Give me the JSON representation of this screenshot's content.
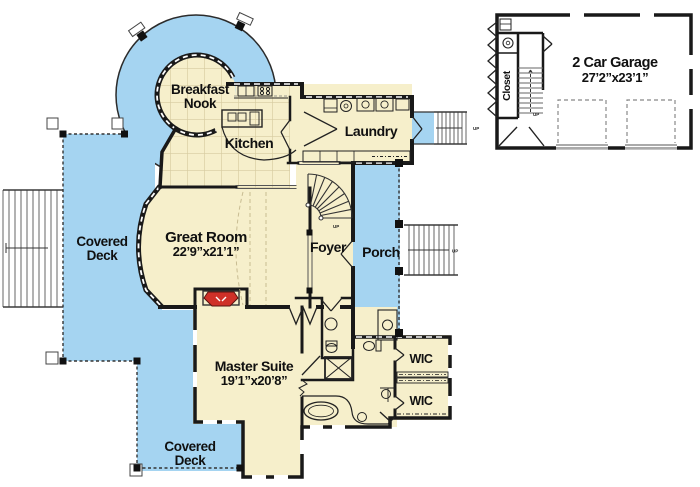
{
  "plan": {
    "labels": {
      "breakfast_nook_1": "Breakfast",
      "breakfast_nook_2": "Nook",
      "kitchen": "Kitchen",
      "laundry": "Laundry",
      "great_room": "Great Room",
      "great_room_dims": "22’9”x21’1”",
      "foyer": "Foyer",
      "porch": "Porch",
      "master_suite": "Master Suite",
      "master_suite_dims": "19’1”x20’8”",
      "wic_upper": "WIC",
      "wic_lower": "WIC",
      "deck_left_1": "Covered",
      "deck_left_2": "Deck",
      "deck_bottom_1": "Covered",
      "deck_bottom_2": "Deck",
      "garage": "2 Car Garage",
      "garage_dims": "27’2”x23’1”",
      "closet": "Closet",
      "up_landing": "UP",
      "up_porch": "UP",
      "up_foyer": "UP",
      "up_garage": "UP"
    },
    "colors": {
      "deck_blue": "#a5d4f1",
      "floor_cream": "#f6efcb",
      "wall_dark": "#191919",
      "tile_line": "#d6cba0",
      "fireplace_red": "#cf3028",
      "garage_floor": "#ffffff"
    }
  }
}
